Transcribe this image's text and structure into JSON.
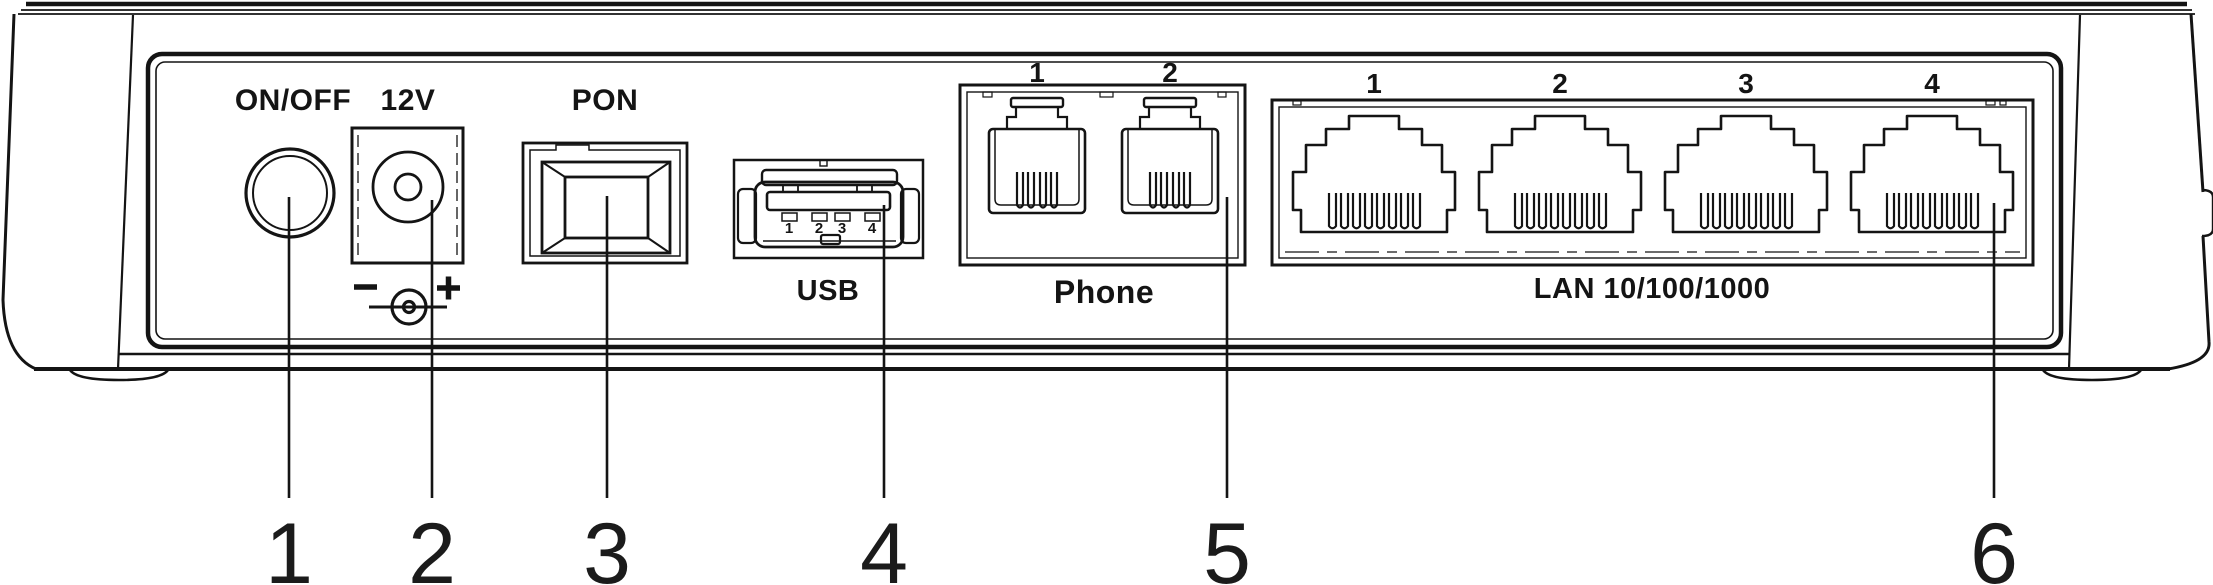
{
  "diagram": {
    "title": "Router rear panel port diagram",
    "power_button": {
      "label": "ON/OFF"
    },
    "dc_jack": {
      "label": "12V",
      "polarity_minus": "−",
      "polarity_plus": "+"
    },
    "pon": {
      "label": "PON"
    },
    "usb": {
      "label": "USB",
      "pins": [
        "1",
        "2",
        "3",
        "4"
      ]
    },
    "phone": {
      "label": "Phone",
      "ports": [
        "1",
        "2"
      ]
    },
    "lan": {
      "label": "LAN 10/100/1000",
      "ports": [
        "1",
        "2",
        "3",
        "4"
      ]
    },
    "callouts": [
      "1",
      "2",
      "3",
      "4",
      "5",
      "6"
    ]
  }
}
